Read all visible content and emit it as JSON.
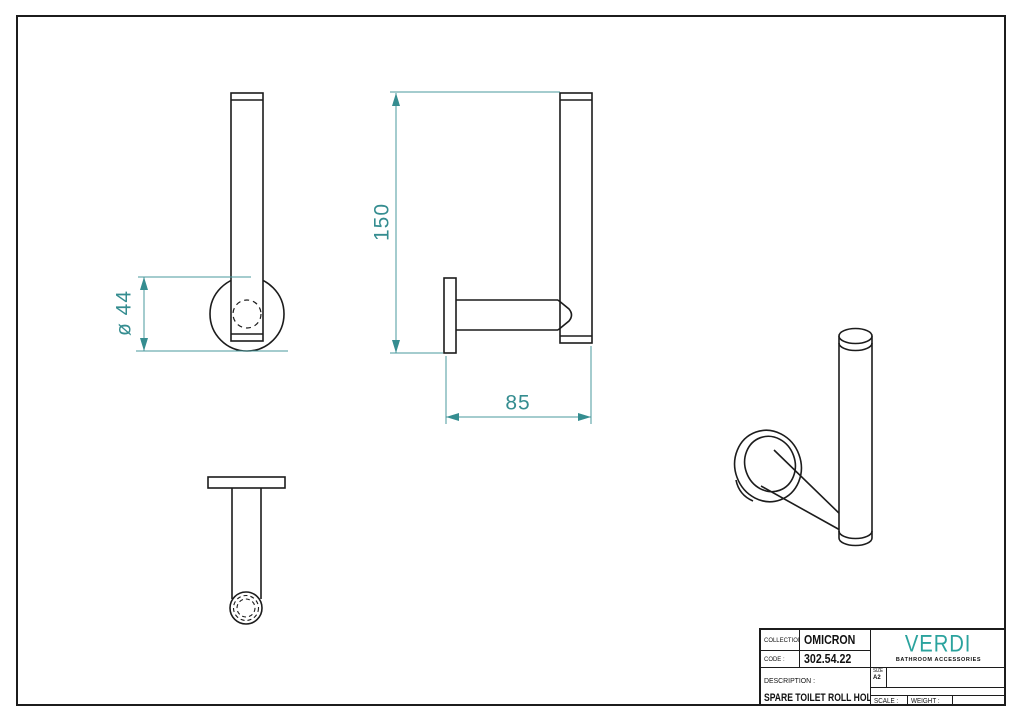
{
  "sheet": {
    "type": "technical-drawing",
    "line_color": "#1c1c1c",
    "background": "#ffffff"
  },
  "dimensions": {
    "height_mm": "150",
    "arm_length_mm": "85",
    "flange_diameter": "ø 44",
    "color": "#358d90"
  },
  "title_block": {
    "collection": {
      "label": "COLLECTION :",
      "value": "OMICRON"
    },
    "code": {
      "label": "CODE :",
      "value": "302.54.22"
    },
    "description": {
      "label": "DESCRIPTION :",
      "value": "SPARE TOILET ROLL HOLDER"
    },
    "size": {
      "label": "SIZE",
      "value": "A2"
    },
    "scale": {
      "label": "SCALE :"
    },
    "weight": {
      "label": "WEIGHT :"
    },
    "brand": {
      "name": "VERDI",
      "tagline": "BATHROOM ACCESSORIES",
      "color": "#2ba39e"
    }
  }
}
